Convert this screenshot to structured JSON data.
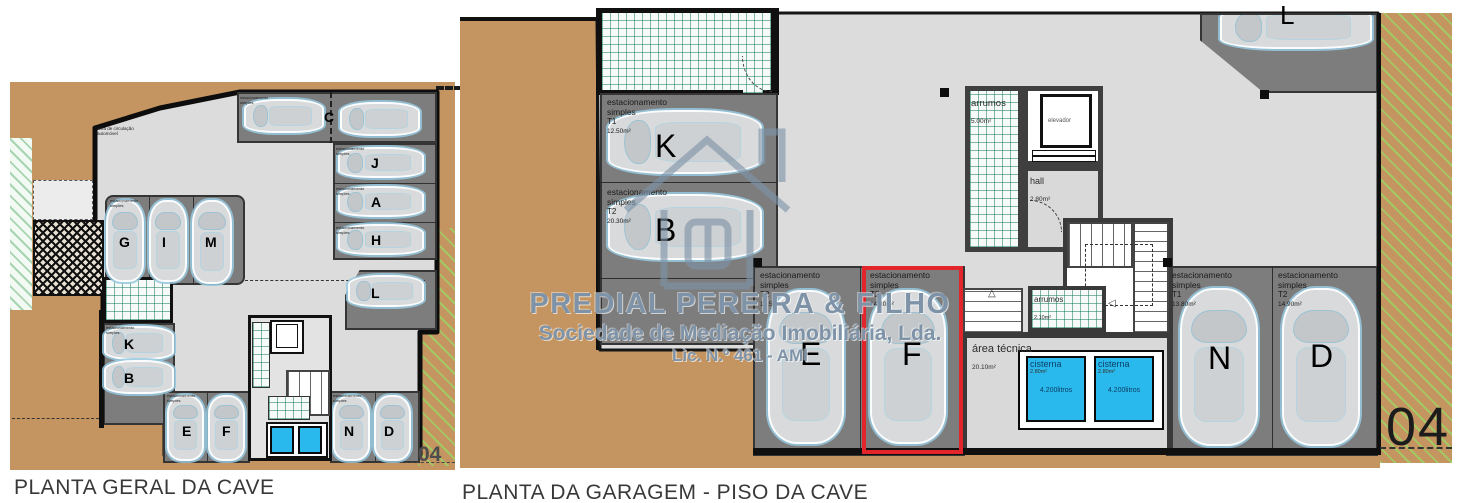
{
  "colors": {
    "terrain": "#c49560",
    "floor": "#dcdcdc",
    "stall": "#7d7d7d",
    "cistern": "#29b9ec",
    "highlight": "#e2242b",
    "watermark": "#7e93a8",
    "grid_green": "#1e7d64"
  },
  "watermark": {
    "line1": "PREDIAL PEREIRA & FILHO",
    "line2": "Sociedade de Mediação Imobiliária, Lda.",
    "line3": "Lic. N.º 461 - AMI"
  },
  "left_plan": {
    "title": "PLANTA GERAL DA CAVE",
    "sheet_number": "04",
    "note_line1": "área de circulação",
    "note_line2": "automóvel",
    "stall_label": {
      "line1": "estacionamento",
      "line2": "simples"
    },
    "spots": {
      "c": "C",
      "j": "J",
      "a": "A",
      "h": "H",
      "l": "L",
      "g": "G",
      "i": "I",
      "m": "M",
      "k": "K",
      "b": "B",
      "e": "E",
      "f": "F",
      "n": "N",
      "d": "D"
    }
  },
  "right_plan": {
    "title": "PLANTA DA GARAGEM - PISO DA CAVE",
    "sheet_number": "04",
    "rooms": {
      "arrumos1": {
        "name": "arrumos",
        "area": "5.00m²"
      },
      "elevador": {
        "name": "elevador"
      },
      "hall": {
        "name": "hall",
        "area": "2.80m²"
      },
      "arrumos2": {
        "name": "arrumos",
        "area": "2.10m²"
      },
      "area_tecnica": {
        "name": "área técnica",
        "area": "20.10m²"
      }
    },
    "cisterns": {
      "c1": {
        "name": "cisterna",
        "area": "2.80m²",
        "capacity": "4.200litros"
      },
      "c2": {
        "name": "cisterna",
        "area": "2.80m²",
        "capacity": "4.200litros"
      }
    },
    "spots": {
      "k": {
        "id": "K",
        "line1": "estacionamento",
        "line2": "simples",
        "tipo": "T1",
        "area": "12.50m²"
      },
      "b": {
        "id": "B",
        "line1": "estacionamento",
        "line2": "simples",
        "tipo": "T2",
        "area": "20.30m²"
      },
      "e": {
        "id": "E",
        "line1": "estacionamento",
        "line2": "simples",
        "tipo": "T2",
        "area": "15.50m²"
      },
      "f": {
        "id": "F",
        "line1": "estacionamento",
        "line2": "simples",
        "tipo": "T2",
        "area": "14.30m²",
        "highlighted": "true"
      },
      "n": {
        "id": "N",
        "line1": "estacionamento",
        "line2": "simples",
        "tipo": "T1",
        "area": "13.80m²"
      },
      "d": {
        "id": "D",
        "line1": "estacionamento",
        "line2": "simples",
        "tipo": "T2",
        "area": "14.90m²"
      },
      "l": {
        "id": "L"
      }
    }
  }
}
